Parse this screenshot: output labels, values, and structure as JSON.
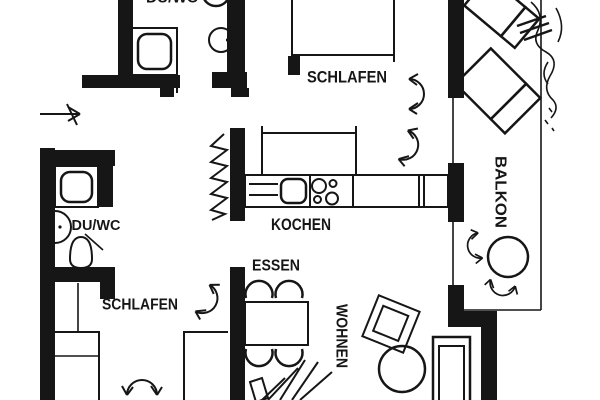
{
  "drawing": {
    "kind": "apartment floor plan",
    "colors": {
      "background": "#ffffff",
      "ink": "#161616"
    }
  },
  "rooms": {
    "bath_top": {
      "label": "DU/WC"
    },
    "bedroom_top": {
      "label": "SCHLAFEN"
    },
    "kitchen": {
      "label": "KOCHEN"
    },
    "dining": {
      "label": "ESSEN"
    },
    "living": {
      "label": "WOHNEN"
    },
    "bedroom_bottom": {
      "label": "SCHLAFEN"
    },
    "bath_bottom": {
      "label": "DU/WC"
    },
    "balcony": {
      "label": "BALKON"
    }
  }
}
